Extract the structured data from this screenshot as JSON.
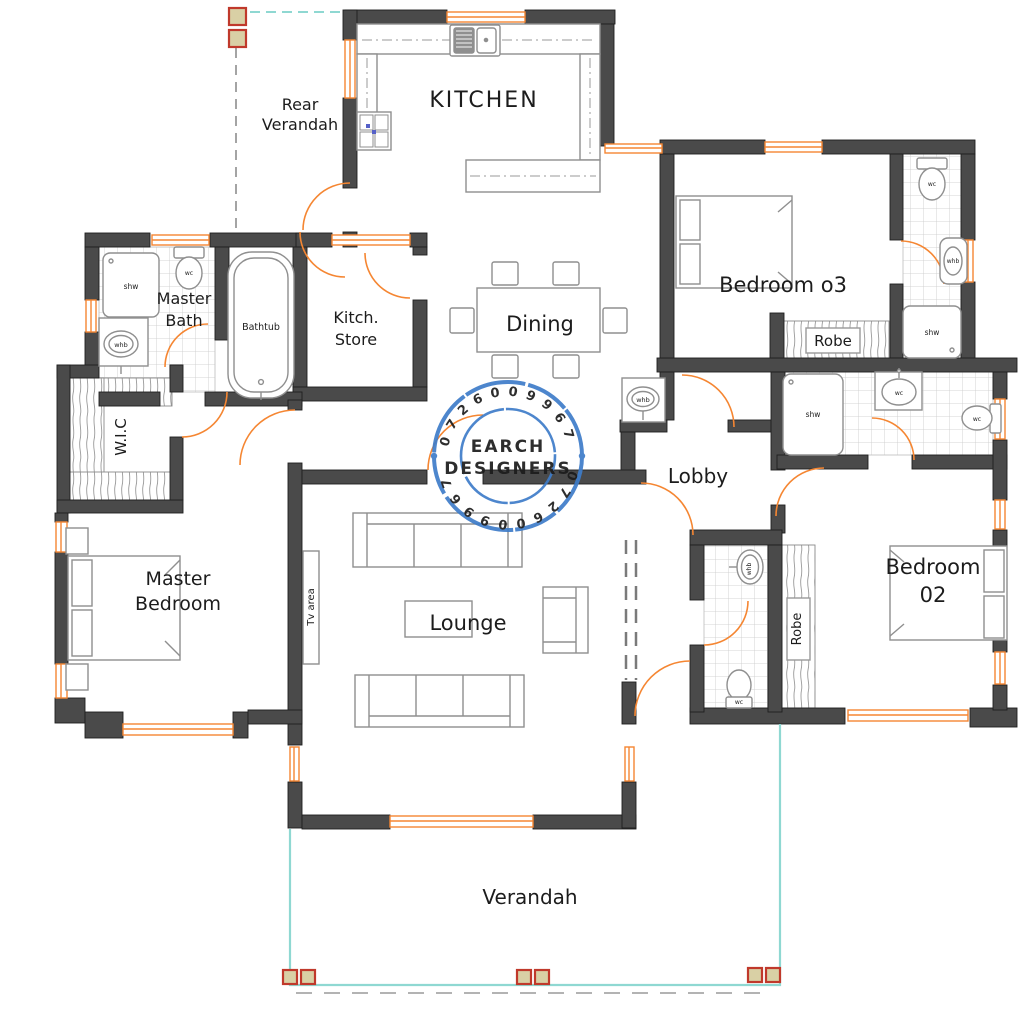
{
  "title": "House floor plan drawing",
  "colors": {
    "wall": "#4a4a4a",
    "wall_edge": "#1f1f1f",
    "accent_orange": "#F58632",
    "teal": "#8FD8D2",
    "stamp_blue": "#3E7CC9",
    "stamp_orange": "#CC6B3A",
    "column_red": "#C0392B",
    "column_fill": "#D9D0A5",
    "furniture": "#8f8f8f",
    "tile_line": "#c9c9c9"
  },
  "rooms": {
    "kitchen": "KITCHEN",
    "rear_verandah": {
      "line1": "Rear",
      "line2": "Verandah"
    },
    "dining": "Dining",
    "master_bath": {
      "line1": "Master",
      "line2": "Bath"
    },
    "kitch_store": {
      "line1": "Kitch.",
      "line2": "Store"
    },
    "bedroom_03": "Bedroom o3",
    "robe": "Robe",
    "wic": "W.I.C",
    "master_bedroom": {
      "line1": "Master",
      "line2": "Bedroom"
    },
    "lounge": "Lounge",
    "tv_area": "Tv area",
    "lobby": "Lobby",
    "bedroom_02": {
      "line1": "Bedroom",
      "line2": "02"
    },
    "verandah": "Verandah"
  },
  "fixtures": {
    "shower": "shw",
    "toilet": "wc",
    "basin": "whb",
    "bathtub": "Bathtub"
  },
  "stamp": {
    "name_line1": "EARCH",
    "name_line2": "DESIGNERS",
    "phone": "0726009967"
  }
}
